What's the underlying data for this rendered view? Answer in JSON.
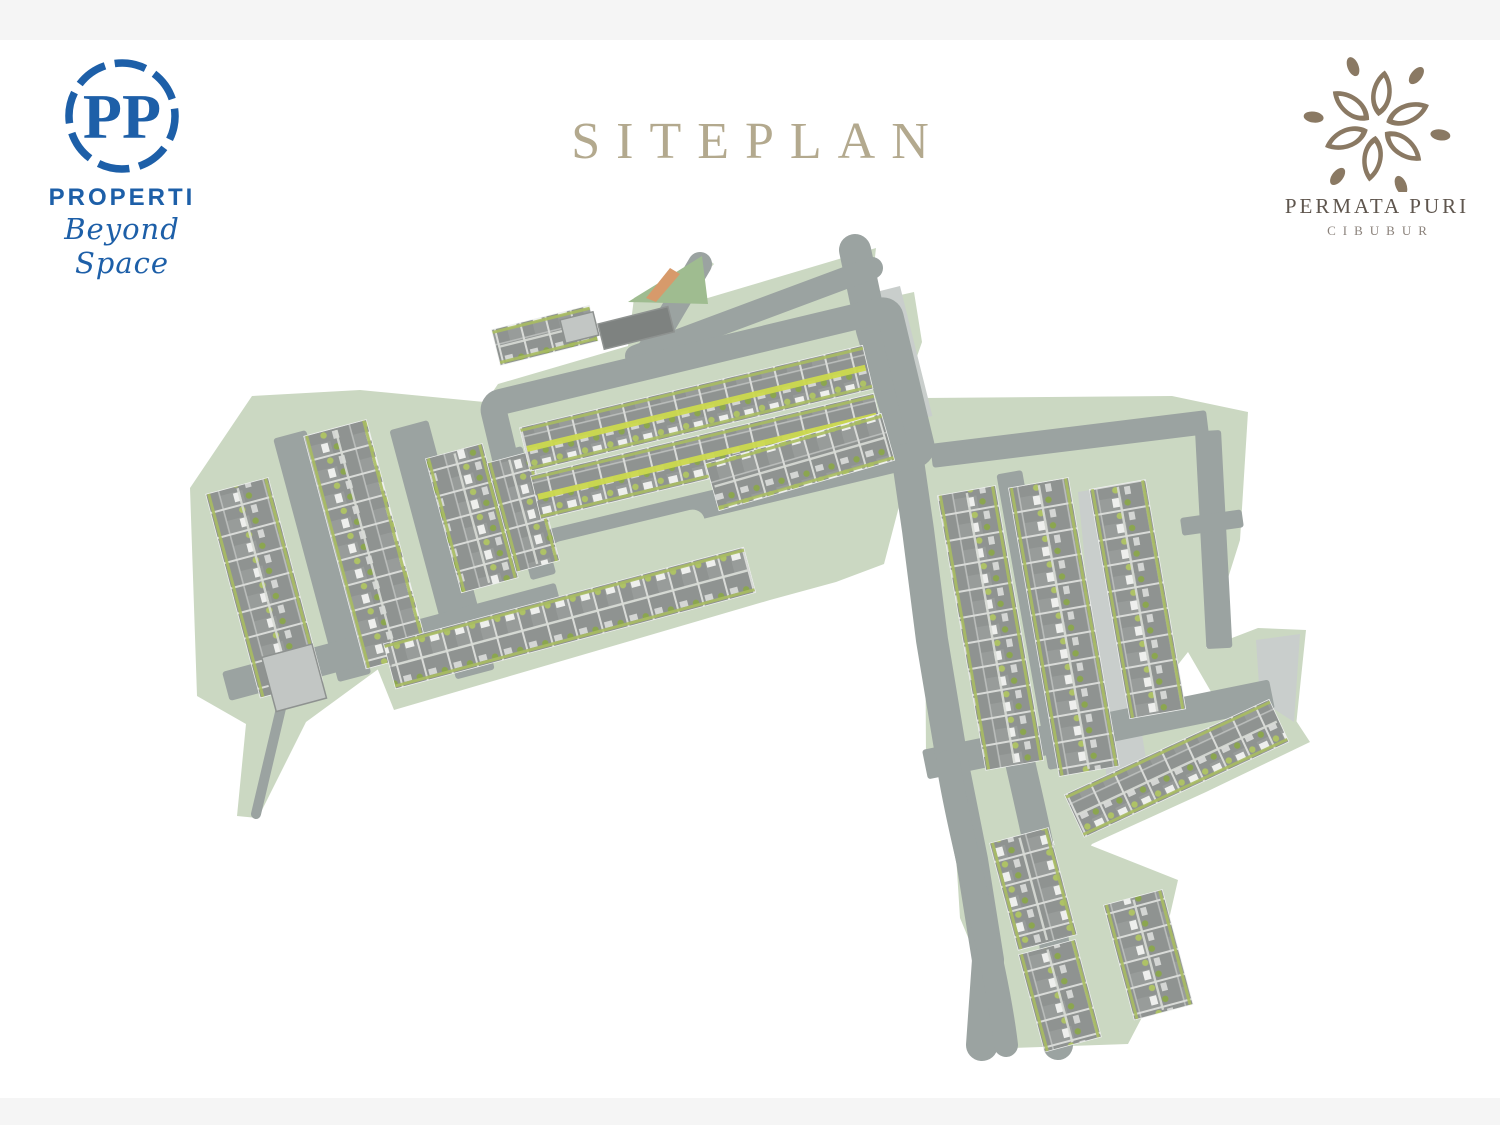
{
  "page": {
    "background": "#ffffff",
    "bar_color": "#f5f5f5"
  },
  "title": {
    "text": "SITEPLAN",
    "color": "#b3a98e"
  },
  "pp_logo": {
    "monogram": "PP",
    "name": "PROPERTI",
    "tagline": "Beyond Space",
    "color": "#1d5fa8"
  },
  "project_logo": {
    "name": "PERMATA PURI",
    "location": "CIBUBUR",
    "flower_color": "#8a7963",
    "name_color": "#5f564e",
    "location_color": "#8a817a"
  },
  "siteplan": {
    "colors": {
      "green": "#cbd8c2",
      "green_dark": "#9fbc90",
      "road": "#9ba3a1",
      "road_light": "#c9cecc",
      "house_base": "#8f9391",
      "edge_bush": "#a9bd62",
      "stripe_yellow": "#ccd94e",
      "stripe_light": "#d8dbd6",
      "row_outline": "#eef0ee",
      "entrance_orange": "#d79a6b",
      "building": "#c2c6c4",
      "building_dark": "#7e8280"
    },
    "green_zones": [
      {
        "name": "green-zone-west",
        "pts": [
          [
            190,
            488
          ],
          [
            252,
            396
          ],
          [
            360,
            390
          ],
          [
            505,
            404
          ],
          [
            560,
            440
          ],
          [
            538,
            606
          ],
          [
            470,
            648
          ],
          [
            420,
            684
          ],
          [
            388,
            662
          ],
          [
            306,
            722
          ],
          [
            258,
            818
          ],
          [
            237,
            816
          ],
          [
            246,
            724
          ],
          [
            197,
            696
          ]
        ]
      },
      {
        "name": "green-zone-center",
        "pts": [
          [
            468,
            428
          ],
          [
            498,
            384
          ],
          [
            628,
            346
          ],
          [
            634,
            298
          ],
          [
            704,
            256
          ],
          [
            714,
            264
          ],
          [
            674,
            308
          ],
          [
            876,
            248
          ],
          [
            870,
            302
          ],
          [
            914,
            292
          ],
          [
            922,
            342
          ],
          [
            890,
            434
          ],
          [
            908,
            472
          ],
          [
            884,
            564
          ],
          [
            836,
            582
          ],
          [
            770,
            600
          ],
          [
            394,
            710
          ],
          [
            370,
            650
          ],
          [
            428,
            598
          ],
          [
            458,
            568
          ],
          [
            458,
            470
          ]
        ]
      },
      {
        "name": "green-zone-east-row",
        "pts": [
          [
            696,
            466
          ],
          [
            890,
            402
          ],
          [
            904,
            456
          ],
          [
            712,
            524
          ]
        ]
      },
      {
        "name": "green-zone-right",
        "pts": [
          [
            924,
            398
          ],
          [
            1172,
            396
          ],
          [
            1248,
            412
          ],
          [
            1240,
            540
          ],
          [
            1206,
            648
          ],
          [
            1258,
            628
          ],
          [
            1306,
            630
          ],
          [
            1296,
            726
          ],
          [
            1232,
            728
          ],
          [
            1188,
            652
          ],
          [
            1150,
            700
          ],
          [
            1066,
            806
          ],
          [
            1042,
            872
          ],
          [
            986,
            840
          ],
          [
            926,
            760
          ]
        ]
      },
      {
        "name": "green-zone-southeast",
        "pts": [
          [
            1040,
            770
          ],
          [
            1268,
            678
          ],
          [
            1310,
            742
          ],
          [
            1206,
            792
          ],
          [
            1092,
            844
          ],
          [
            1062,
            884
          ]
        ]
      },
      {
        "name": "green-zone-bottom",
        "pts": [
          [
            952,
            792
          ],
          [
            1046,
            846
          ],
          [
            1082,
            842
          ],
          [
            1178,
            880
          ],
          [
            1150,
            1002
          ],
          [
            1128,
            1044
          ],
          [
            1014,
            1048
          ],
          [
            960,
            918
          ]
        ]
      }
    ],
    "parking_areas": [
      {
        "name": "parking-strip-north",
        "band": {
          "x": 900,
          "y": 286,
          "L": 134,
          "th": 38,
          "rot": 76
        }
      },
      {
        "name": "parking-wedge-right",
        "pts": [
          [
            1078,
            492
          ],
          [
            1102,
            488
          ],
          [
            1152,
            796
          ],
          [
            1110,
            812
          ]
        ]
      },
      {
        "name": "parking-corner-southeast",
        "pts": [
          [
            1256,
            640
          ],
          [
            1300,
            634
          ],
          [
            1294,
            722
          ],
          [
            1260,
            700
          ]
        ]
      }
    ],
    "road_bands": [
      {
        "name": "road-west-1",
        "x": 306,
        "y": 430,
        "L": 252,
        "th": 34,
        "rot": 75
      },
      {
        "name": "road-west-2",
        "x": 428,
        "y": 420,
        "L": 258,
        "th": 40,
        "rot": 75
      },
      {
        "name": "road-west-3",
        "x": 522,
        "y": 446,
        "L": 132,
        "th": 26,
        "rot": 75
      },
      {
        "name": "road-west-south",
        "x": 222,
        "y": 672,
        "L": 345,
        "th": 30,
        "rot": -15
      },
      {
        "name": "road-right-inner",
        "x": 1022,
        "y": 470,
        "L": 300,
        "th": 26,
        "rot": 80
      },
      {
        "name": "road-right-north",
        "x": 930,
        "y": 444,
        "L": 278,
        "th": 24,
        "rot": -7
      },
      {
        "name": "road-right-east",
        "x": 1221,
        "y": 430,
        "L": 218,
        "th": 26,
        "rot": 87
      },
      {
        "name": "road-right-south",
        "x": 922,
        "y": 750,
        "L": 354,
        "th": 30,
        "rot": -11.5
      },
      {
        "name": "road-spur-east",
        "x": 1180,
        "y": 518,
        "L": 62,
        "th": 18,
        "rot": -8
      }
    ],
    "road_paths": [
      {
        "name": "road-main-spine",
        "d": "M855,250 L872,330 L905,440 L918,530 L932,640 L952,760 L972,860 L988,960 L982,1045",
        "w": 32
      },
      {
        "name": "road-entrance",
        "d": "M700,264 L648,352",
        "w": 24
      },
      {
        "name": "road-north-loop",
        "d": "M636,356 L872,268",
        "w": 22
      },
      {
        "name": "road-descend-east",
        "d": "M1020,762 C1040,850 1062,940 1058,1045",
        "w": 30
      },
      {
        "name": "road-descend-west",
        "d": "M948,762 C962,850 996,960 1006,1045",
        "w": 24
      },
      {
        "name": "path-west-tail",
        "d": "M282,704 L256,814",
        "w": 10
      }
    ],
    "road_loop": {
      "name": "road-center-loop",
      "x": 492,
      "y": 404,
      "L": 408,
      "th": 148,
      "rot": -13.5,
      "stroke_w": 26
    },
    "median_island": {
      "name": "road-median-island",
      "x": 548,
      "y": 544,
      "L": 158,
      "th": 24,
      "rot": -13.5
    },
    "house_rows": [
      {
        "name": "house-row-west-1",
        "x": 268,
        "y": 478,
        "L": 210,
        "th": 64,
        "rot": 75
      },
      {
        "name": "house-row-west-2",
        "x": 366,
        "y": 420,
        "L": 240,
        "th": 64,
        "rot": 75
      },
      {
        "name": "house-row-west-3",
        "x": 482,
        "y": 444,
        "L": 138,
        "th": 58,
        "rot": 75
      },
      {
        "name": "house-row-west-4",
        "x": 530,
        "y": 452,
        "L": 112,
        "th": 44,
        "rot": 75
      },
      {
        "name": "house-row-center-1",
        "x": 520,
        "y": 428,
        "L": 352,
        "th": 44,
        "rot": -13.5,
        "stripe": "yellow"
      },
      {
        "name": "house-row-center-2",
        "x": 531,
        "y": 476,
        "L": 352,
        "th": 44,
        "rot": -13.5,
        "stripe": "yellow"
      },
      {
        "name": "house-row-center-top",
        "x": 492,
        "y": 330,
        "L": 100,
        "th": 36,
        "rot": -14
      },
      {
        "name": "house-row-east",
        "x": 706,
        "y": 464,
        "L": 182,
        "th": 48,
        "rot": -16
      },
      {
        "name": "house-row-southwest",
        "x": 384,
        "y": 644,
        "L": 372,
        "th": 46,
        "rot": -15
      },
      {
        "name": "house-row-right-1",
        "x": 995,
        "y": 486,
        "L": 278,
        "th": 58,
        "rot": 80
      },
      {
        "name": "house-row-right-2",
        "x": 1068,
        "y": 478,
        "L": 292,
        "th": 60,
        "rot": 80
      },
      {
        "name": "house-row-right-3",
        "x": 1145,
        "y": 480,
        "L": 232,
        "th": 56,
        "rot": 80
      },
      {
        "name": "house-row-southeast",
        "x": 1065,
        "y": 795,
        "L": 225,
        "th": 46,
        "rot": -25
      },
      {
        "name": "house-row-bottom-1",
        "x": 1048,
        "y": 828,
        "L": 110,
        "th": 60,
        "rot": 75
      },
      {
        "name": "house-row-bottom-2",
        "x": 1075,
        "y": 940,
        "L": 100,
        "th": 58,
        "rot": 75
      },
      {
        "name": "house-row-bottom-3",
        "x": 1162,
        "y": 890,
        "L": 118,
        "th": 60,
        "rot": 75
      }
    ],
    "features": {
      "entrance_triangle": {
        "name": "entrance-lawn",
        "pts": [
          [
            628,
            302
          ],
          [
            702,
            256
          ],
          [
            708,
            304
          ]
        ]
      },
      "entrance_orange": {
        "name": "entrance-gate-stripe",
        "pts": [
          [
            646,
            298
          ],
          [
            670,
            268
          ],
          [
            680,
            274
          ],
          [
            656,
            302
          ]
        ]
      },
      "buildings": [
        {
          "name": "entrance-building",
          "x": 598,
          "y": 324,
          "L": 72,
          "th": 26,
          "rot": -14,
          "fill": "dark"
        },
        {
          "name": "gatehouse",
          "x": 560,
          "y": 320,
          "L": 34,
          "th": 24,
          "rot": -14,
          "fill": "light"
        },
        {
          "name": "west-facility",
          "x": 312,
          "y": 644,
          "L": 56,
          "th": 52,
          "rot": 75,
          "fill": "light"
        }
      ]
    }
  }
}
